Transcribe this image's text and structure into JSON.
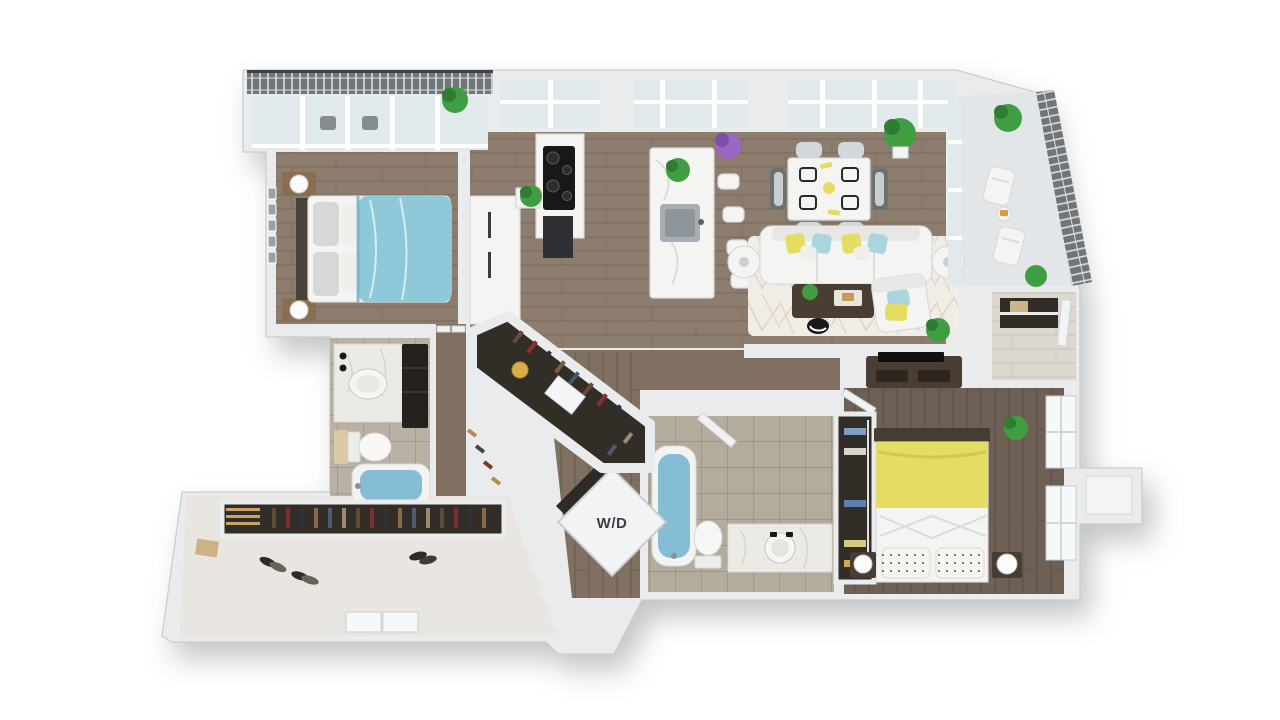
{
  "labels": {
    "washer_dryer": "W/D"
  },
  "palette": {
    "bg": "#ffffff",
    "wall": "#e9ebed",
    "wall_edge": "#c7ccd1",
    "wall_shadow": "#d9dcdf",
    "wood": "#8d7d6e",
    "wood_mid": "#7f7061",
    "wood_dark": "#6e6055",
    "glass": "#e2e9ec",
    "window": "#f6f9fa",
    "tile": "#b9b2a4",
    "tile2": "#b3ab9c",
    "railing": "#70757a",
    "railing_line": "#dde1e4",
    "blue": "#8ec9da",
    "softblue": "#a9d6de",
    "water": "#85bed4",
    "yellow": "#e4dc63",
    "green": "#3f9e42",
    "green_dark": "#2f7c33",
    "purple": "#9a68c2",
    "rug": "#f1ece6",
    "rug_line": "#dcd2c6",
    "darkwood": "#4a3e33",
    "closet": "#332d28",
    "marble": "#eceae5",
    "white_f": "#f4f4f2",
    "furn_stroke": "#d6dadd",
    "charcoal": "#17181a",
    "text": "#3b4045"
  },
  "regions": [
    "balcony-left",
    "master-bedroom",
    "kitchen",
    "dining-area",
    "living-room",
    "balcony-right",
    "entry-foyer",
    "bedroom-2",
    "closet-2",
    "bathroom-2",
    "laundry-closet",
    "hallway",
    "walk-in-closet",
    "master-bathroom",
    "storage-closet"
  ]
}
